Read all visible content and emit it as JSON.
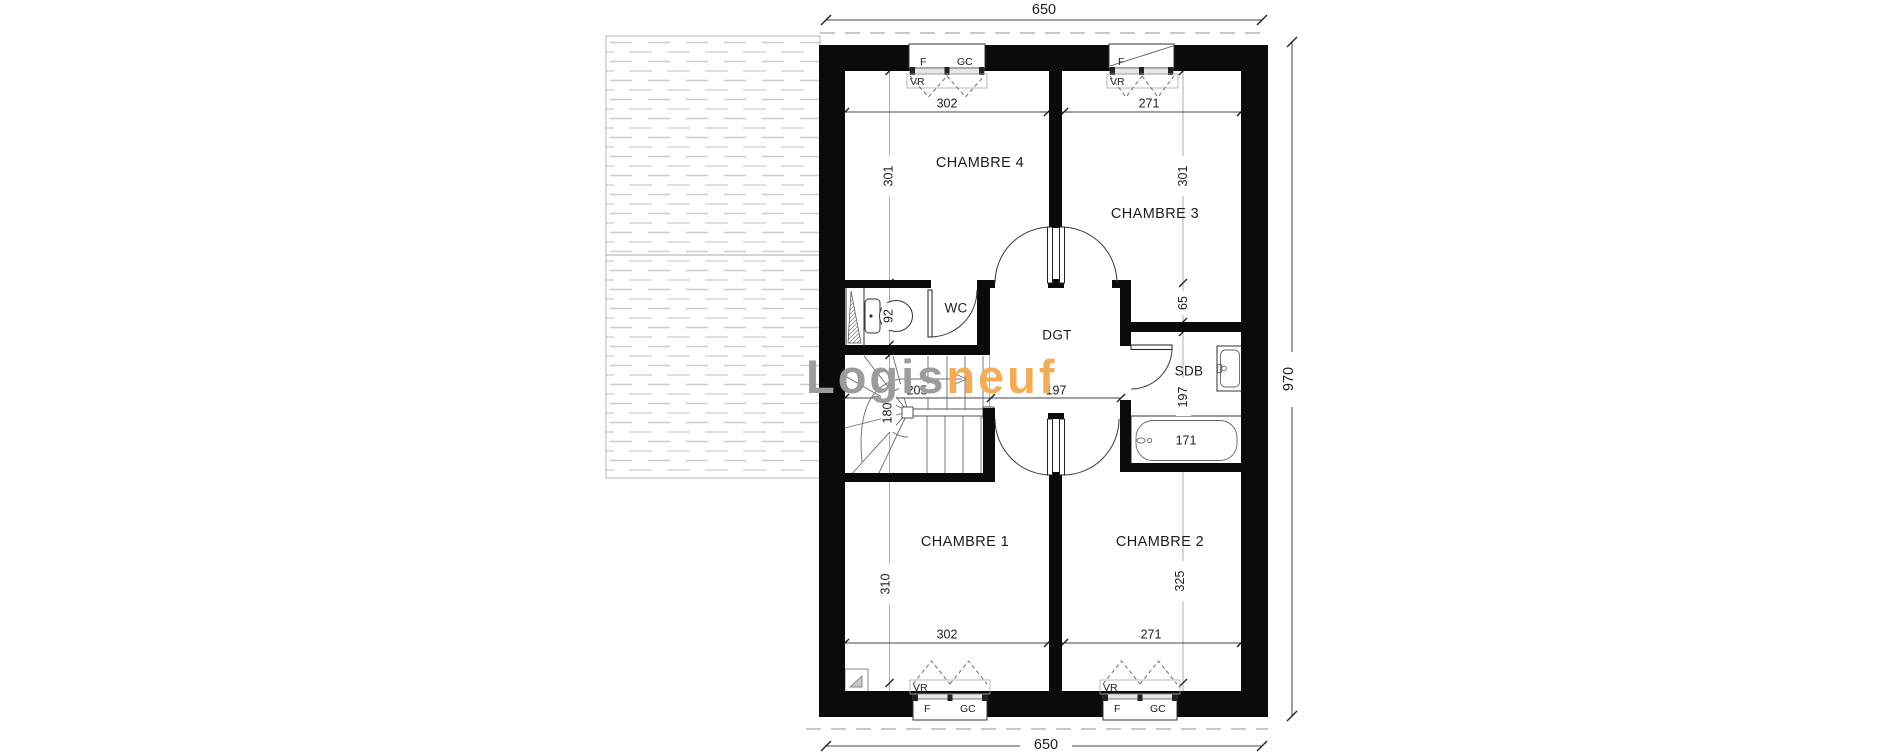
{
  "watermark": {
    "gray_text": "Logis",
    "orange_text": "neuf",
    "gray_color": "#9c9c9c",
    "orange_color": "#f3ad56"
  },
  "overall": {
    "width_top": "650",
    "width_bottom": "650",
    "height": "970"
  },
  "rooms": {
    "chambre4": {
      "label": "CHAMBRE 4",
      "width": "302",
      "height": "301"
    },
    "chambre3": {
      "label": "CHAMBRE 3",
      "width": "271",
      "height": "301"
    },
    "chambre1": {
      "label": "CHAMBRE 1",
      "width": "302",
      "height": "310"
    },
    "chambre2": {
      "label": "CHAMBRE 2",
      "width": "271",
      "height": "325"
    },
    "wc": {
      "label": "WC",
      "height": "92"
    },
    "dgt": {
      "label": "DGT",
      "width": "197"
    },
    "sdb": {
      "label": "SDB",
      "height": "197",
      "offset": "65",
      "bath_length": "171"
    },
    "stairs": {
      "width": "180",
      "landing_width": "205"
    }
  },
  "window_labels": {
    "f": "F",
    "gc": "GC",
    "vr": "VR"
  }
}
